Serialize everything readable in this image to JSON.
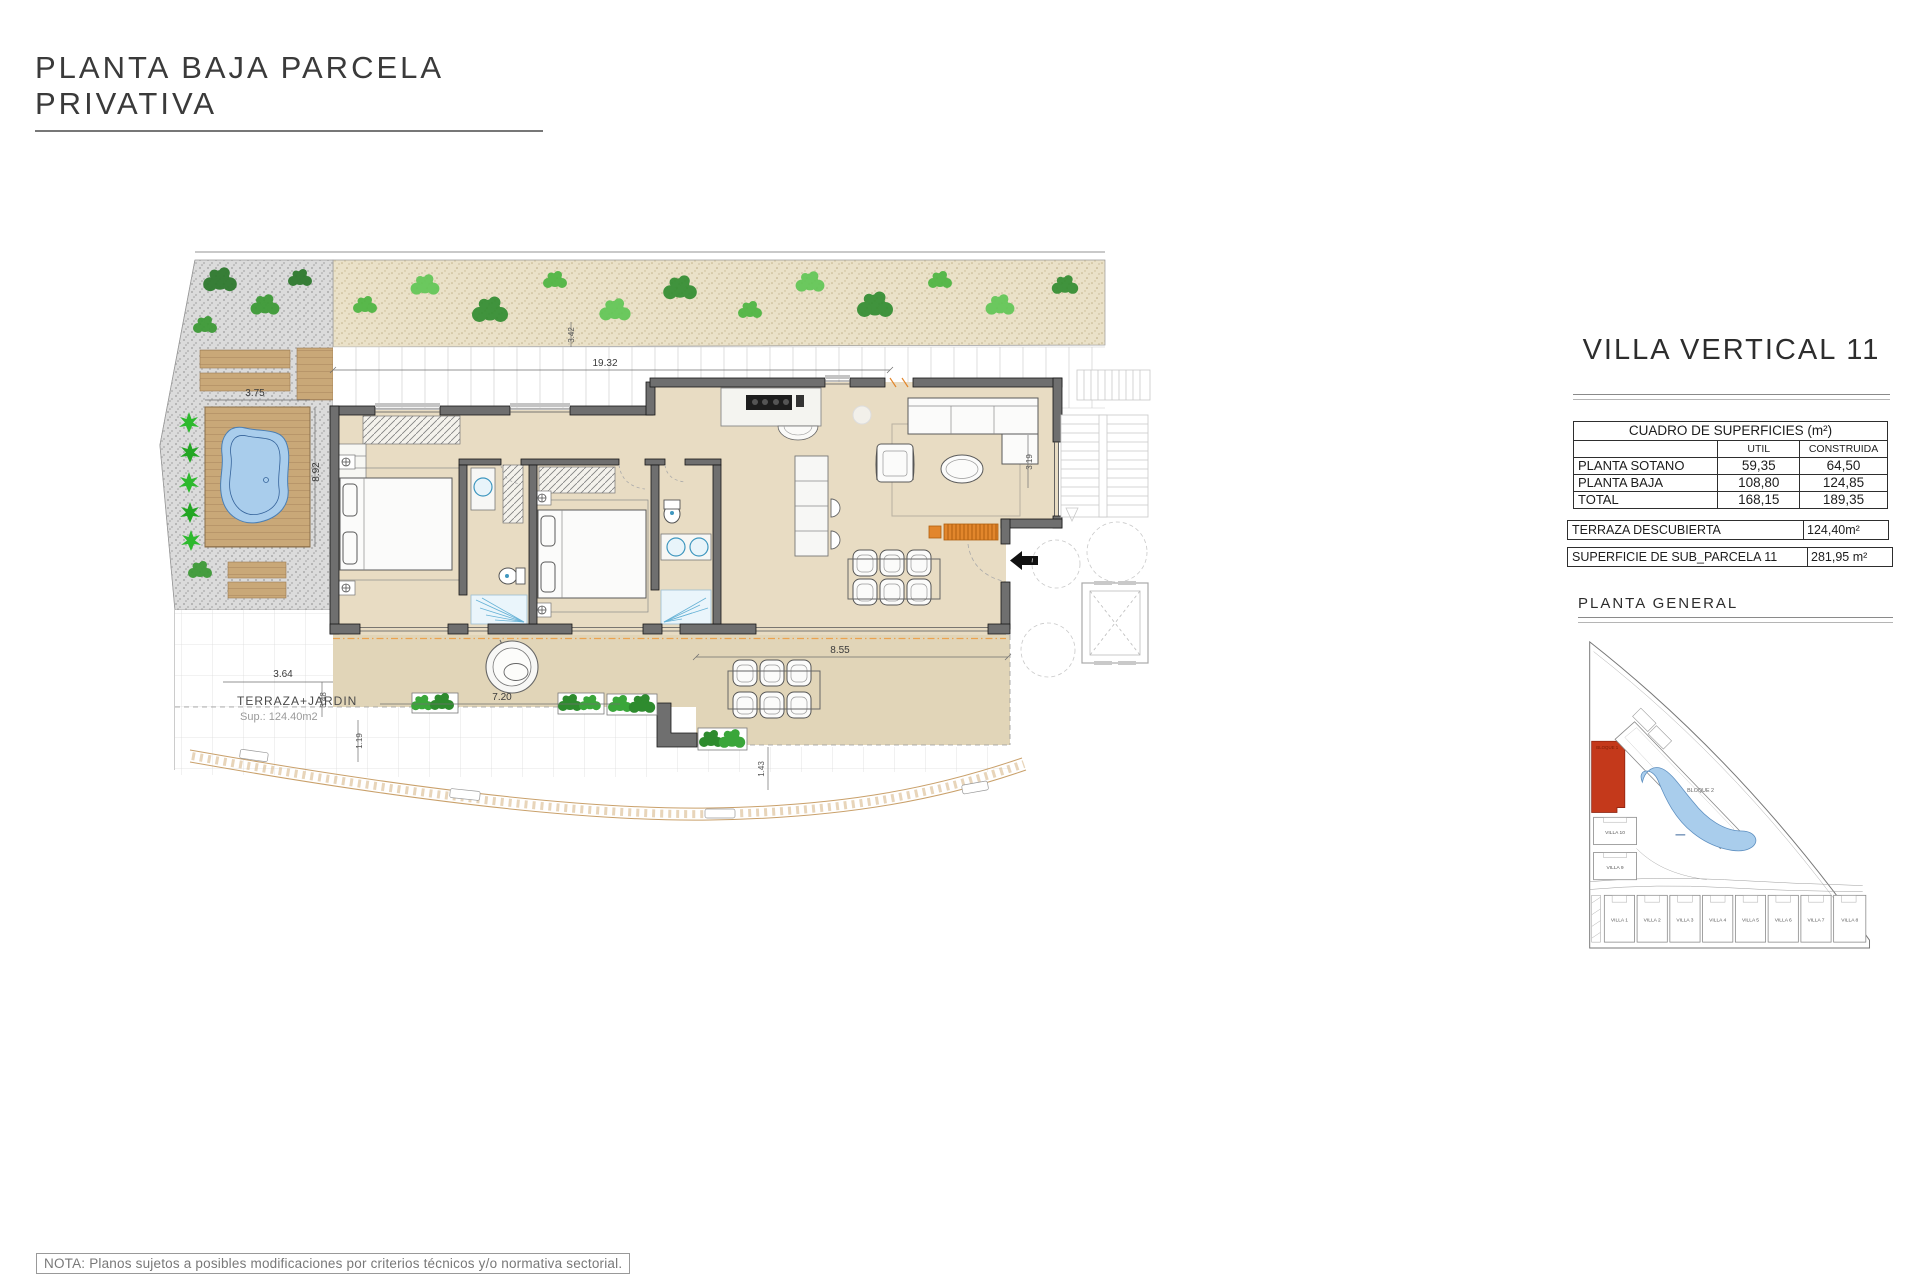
{
  "page": {
    "title": "PLANTA BAJA PARCELA PRIVATIVA",
    "note": "NOTA: Planos sujetos a posibles modificaciones por criterios técnicos y/o normativa sectorial."
  },
  "panel": {
    "title": "VILLA VERTICAL 11",
    "surface_table": {
      "title": "CUADRO DE SUPERFICIES (m²)",
      "col_util": "UTIL",
      "col_construida": "CONSTRUIDA",
      "rows": [
        {
          "label": "PLANTA SOTANO",
          "util": "59,35",
          "construida": "64,50"
        },
        {
          "label": "PLANTA BAJA",
          "util": "108,80",
          "construida": "124,85"
        },
        {
          "label": "TOTAL",
          "util": "168,15",
          "construida": "189,35"
        }
      ]
    },
    "terraza": {
      "label": "TERRAZA DESCUBIERTA",
      "value": "124,40m²"
    },
    "parcela": {
      "label": "SUPERFICIE DE SUB_PARCELA  11",
      "value": "281,95 m²"
    },
    "site_plan_title": "PLANTA  GENERAL"
  },
  "site": {
    "bloque1": "BLOQUE 1",
    "bloque2": "BLOQUE 2",
    "villa10": "VILLA 10",
    "villa9": "VILLA 9",
    "bottom_villas": [
      "VILLA 1",
      "VILLA 2",
      "VILLA 3",
      "VILLA 4",
      "VILLA 5",
      "VILLA 6",
      "VILLA 7",
      "VILLA 8"
    ]
  },
  "plan": {
    "area_label": "TERRAZA+JARDIN",
    "area_sublabel": "Sup.: 124.40m2",
    "dimensions": {
      "top_width": "19.32",
      "garden_depth": "3.42",
      "pool_width": "3.75",
      "pool_length": "8.92",
      "terrace_left_a": "3.64",
      "terrace_left_b": "3.48",
      "terrace_left_c": "1.19",
      "terrace_width": "7.20",
      "terrace_right_width": "8.55",
      "terrace_right_depth": "1.43",
      "living_depth": "3.19"
    }
  },
  "colors": {
    "wall": "#6f6f6f",
    "floor": "#e8dcc3",
    "terrace": "#e1d5b8",
    "sand": "#eae1c8",
    "deck": "#c9a878",
    "pool": "#a9cdec",
    "accent_orange": "#e2862c",
    "site_highlight_red": "#c4391b",
    "fixture_blue": "#3f97bf",
    "plant_green": "#3aa63a"
  }
}
